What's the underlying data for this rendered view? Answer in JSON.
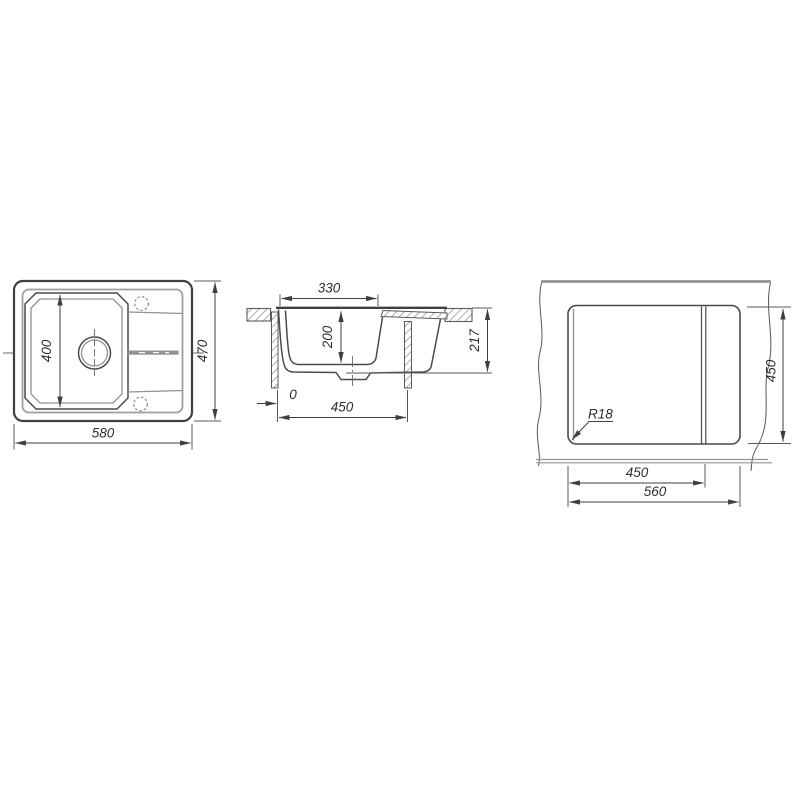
{
  "drawing": {
    "type": "sink-technical-drawing",
    "background": "#ffffff",
    "line_color": "#3f3f3f",
    "soft_line_color": "#8d9296",
    "views": {
      "top_view": {
        "label": "sink-top-view",
        "dims": {
          "overall_width": "580",
          "overall_depth": "470",
          "bowl_length": "400"
        }
      },
      "section_view": {
        "label": "sink-cross-section",
        "dims": {
          "bowl_top_width": "330",
          "bowl_depth": "200",
          "total_height": "217",
          "edge_offset": "0",
          "cabinet_width": "450"
        }
      },
      "cutout_view": {
        "label": "countertop-cutout-view",
        "dims": {
          "cutout_depth": "450",
          "main_cutout_width": "450",
          "cutout_width": "560",
          "corner_radius": "R18"
        }
      }
    }
  }
}
